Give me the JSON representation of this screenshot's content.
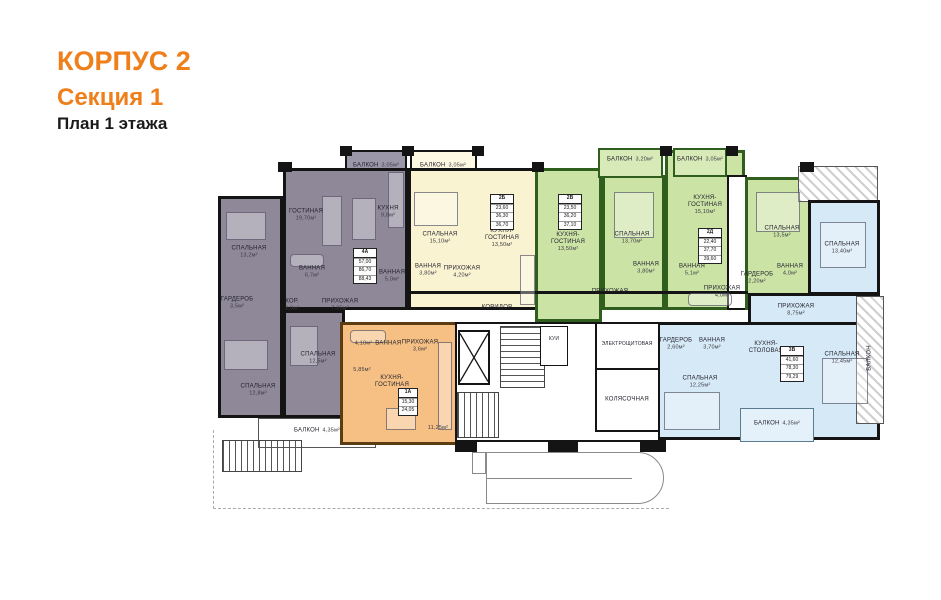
{
  "title": {
    "building": "КОРПУС 2",
    "section": "Секция 1",
    "floor": "План 1 этажа"
  },
  "colors": {
    "accent_orange": "#EF7F1A",
    "apartment_purple": "#8E8899",
    "apartment_yellow": "#FAF3D2",
    "apartment_green": "#CCE3A6",
    "apartment_orange": "#F6C084",
    "apartment_blue": "#D6E9F6",
    "wall_black": "#141414",
    "wall_green": "#2F5E1E",
    "wall_brown": "#5C3D12"
  },
  "apartments": [
    {
      "id": "4А",
      "stats": [
        "57,00",
        "86,70",
        "88,43"
      ],
      "rooms": [
        {
          "name": "СПАЛЬНАЯ",
          "area": "13,2м²"
        },
        {
          "name": "ГОСТИНАЯ",
          "area": "19,70м²"
        },
        {
          "name": "КУХНЯ",
          "area": "9,8м²"
        },
        {
          "name": "ВАННАЯ",
          "area": "6,7м²"
        },
        {
          "name": "ВАННАЯ",
          "area": "5,0м²"
        },
        {
          "name": "ГАРДЕРОБ",
          "area": "3,5м²"
        },
        {
          "name": "КОР.",
          "area": "3,0м²"
        },
        {
          "name": "ПРИХОЖАЯ",
          "area": "7,35м²"
        },
        {
          "name": "СПАЛЬНАЯ",
          "area": "12,8м²"
        },
        {
          "name": "СПАЛЬНАЯ",
          "area": "12,5м²"
        },
        {
          "name": "БАЛКОН",
          "area": "3,05м²"
        },
        {
          "name": "БАЛКОН",
          "area": "4,35м²"
        }
      ]
    },
    {
      "id": "2Б",
      "stats": [
        "23,60",
        "36,30",
        "36,70"
      ],
      "rooms": [
        {
          "name": "БАЛКОН",
          "area": "3,05м²"
        },
        {
          "name": "СПАЛЬНАЯ",
          "area": "15,10м²"
        },
        {
          "name": "КУХНЯ-ГОСТИНАЯ",
          "area": "13,50м²"
        },
        {
          "name": "ВАННАЯ",
          "area": "3,80м²"
        },
        {
          "name": "ПРИХОЖАЯ",
          "area": "4,20м²"
        }
      ]
    },
    {
      "id": "2В",
      "stats": [
        "23,50",
        "36,20",
        "37,10"
      ],
      "rooms": [
        {
          "name": "БАЛКОН",
          "area": "3,20м²"
        },
        {
          "name": "КУХНЯ-ГОСТИНАЯ",
          "area": "13,50м²"
        },
        {
          "name": "СПАЛЬНАЯ",
          "area": "13,70м²"
        },
        {
          "name": "ВАННАЯ",
          "area": "3,80м²"
        },
        {
          "name": "ПРИХОЖАЯ",
          "area": ""
        }
      ]
    },
    {
      "id": "2Д",
      "stats": [
        "22,40",
        "37,70",
        "39,60"
      ],
      "rooms": [
        {
          "name": "БАЛКОН",
          "area": "3,05м²"
        },
        {
          "name": "КУХНЯ-ГОСТИНАЯ",
          "area": "15,10м²"
        },
        {
          "name": "СПАЛЬНАЯ",
          "area": "13,5м²"
        },
        {
          "name": "ВАННАЯ",
          "area": "5,1м²"
        },
        {
          "name": "ВАННАЯ",
          "area": "4,0м²"
        },
        {
          "name": "ГАРДЕРОБ",
          "area": "2,20м²"
        },
        {
          "name": "ПРИХОЖАЯ",
          "area": "4,0м²"
        }
      ]
    },
    {
      "id": "3В",
      "stats": [
        "41,60",
        "78,30",
        "79,29"
      ],
      "rooms": [
        {
          "name": "СПАЛЬНАЯ",
          "area": "13,40м²"
        },
        {
          "name": "ПРИХОЖАЯ",
          "area": "8,75м²"
        },
        {
          "name": "КУХНЯ-СТОЛОВАЯ",
          "area": ""
        },
        {
          "name": "СПАЛЬНАЯ",
          "area": "12,45м²"
        },
        {
          "name": "СПАЛЬНАЯ",
          "area": "12,25м²"
        },
        {
          "name": "ГАРДЕРОБ",
          "area": "2,60м²"
        },
        {
          "name": "ВАННАЯ",
          "area": "3,70м²"
        },
        {
          "name": "БАЛКОН",
          "area": "4,35м²"
        },
        {
          "name": "БАЛКОН",
          "area": ""
        }
      ]
    },
    {
      "id": "1А",
      "stats": [
        "15,30",
        "24,05"
      ],
      "rooms": [
        {
          "name": "ВАННАЯ",
          "area": "4,10м²"
        },
        {
          "name": "ПРИХОЖАЯ",
          "area": "3,6м²"
        },
        {
          "name": "КУХНЯ-ГОСТИНАЯ",
          "area": ""
        },
        {
          "name": "",
          "area": "5,85м²"
        },
        {
          "name": "",
          "area": "11,25м²"
        }
      ]
    }
  ],
  "common": {
    "corridor": "КОРИДОР",
    "electrical": "ЭЛЕКТРОЩИТОВАЯ",
    "stroller": "КОЛЯСОЧНАЯ",
    "utility": "КУИ"
  }
}
